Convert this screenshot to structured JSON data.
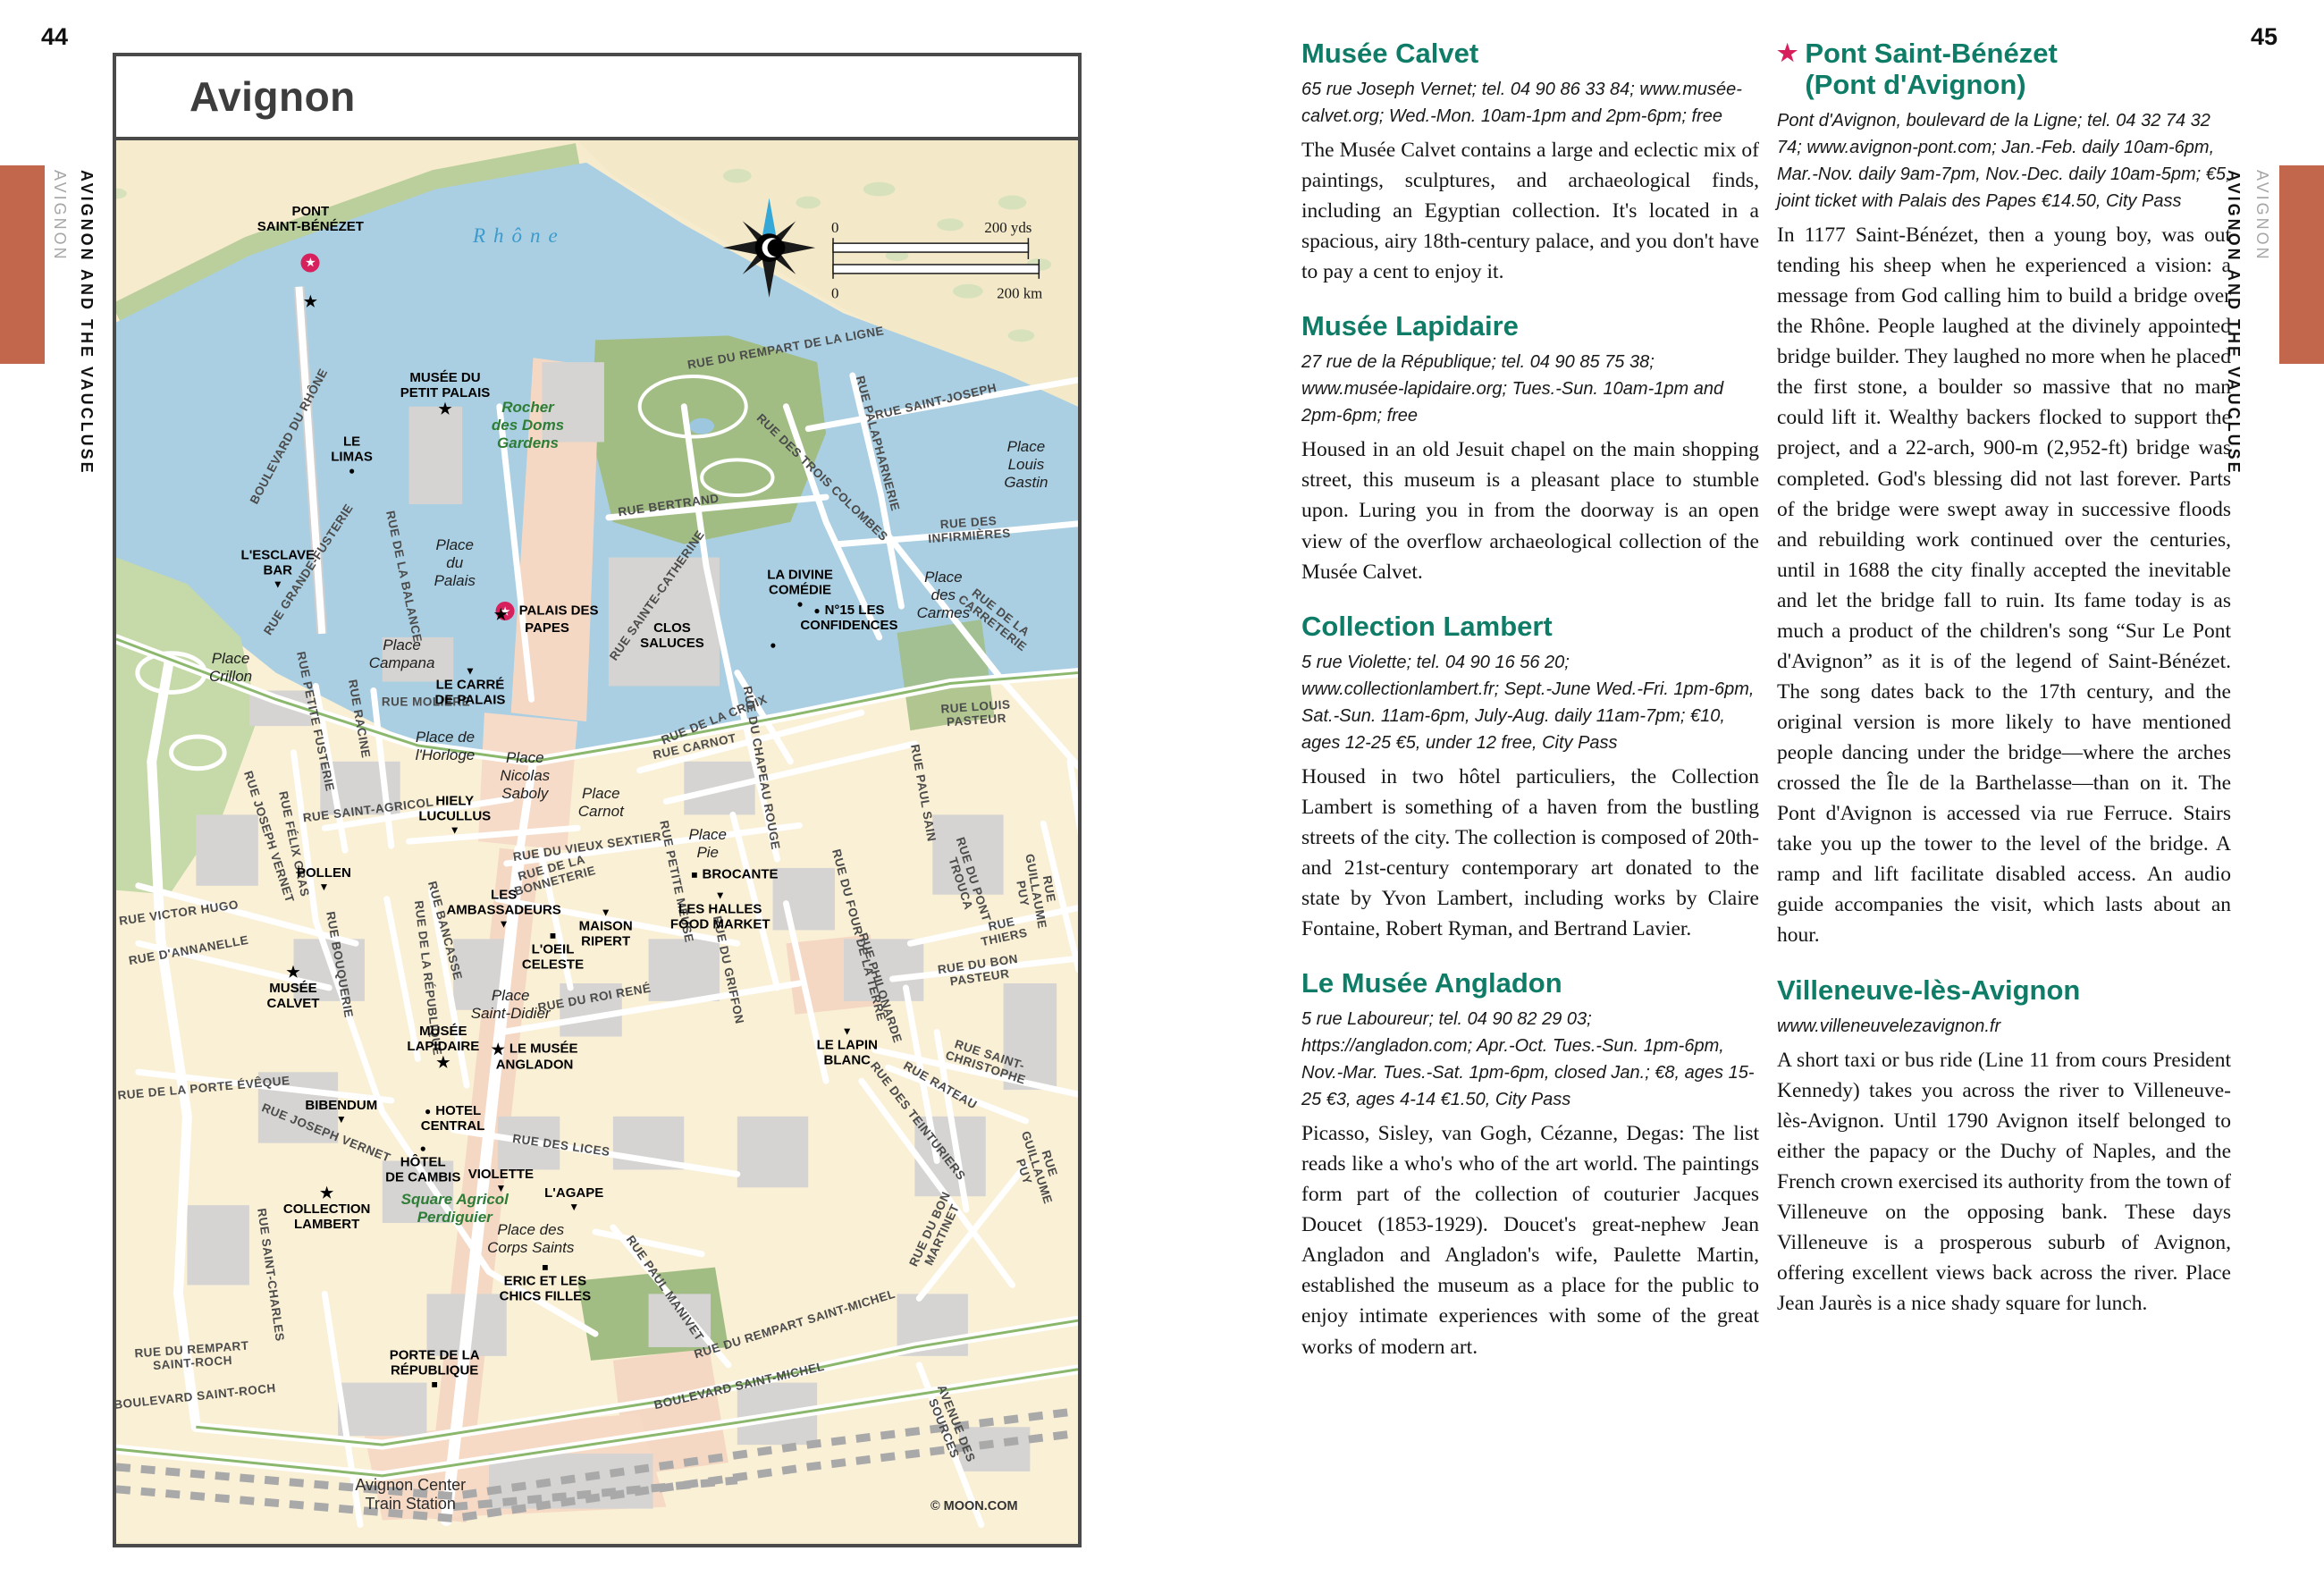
{
  "page": {
    "left_number": "44",
    "right_number": "45",
    "sidebar": {
      "title": "AVIGNON AND THE VAUCLUSE",
      "subtitle": "AVIGNON"
    },
    "accent_color": "#C2674B",
    "heading_color": "#0E7C66",
    "star_color": "#D71F5B"
  },
  "map": {
    "title": "Avignon",
    "credit": "© MOON.COM",
    "scale": {
      "zero_top": "0",
      "top": "200 yds",
      "zero_bottom": "0",
      "bottom": "200 km"
    },
    "labels": [
      {
        "t": "PONT\nSAINT-BÉNÉZET",
        "x": 20.2,
        "y": 5.6,
        "type": "poi"
      },
      {
        "t": "",
        "x": 20.2,
        "y": 8.7,
        "type": "glyph",
        "icon": "red-star"
      },
      {
        "t": "",
        "x": 20.2,
        "y": 11.5,
        "type": "glyph",
        "icon": "star"
      },
      {
        "t": "Rhône",
        "x": 41.9,
        "y": 6.8,
        "type": "water"
      },
      {
        "t": "BOULEVARD DU RHÔNE",
        "x": 17.9,
        "y": 21.1,
        "type": "street",
        "rot": -62
      },
      {
        "t": "RUE DU REMPART DE LA LIGNE",
        "x": 69.6,
        "y": 14.8,
        "type": "street",
        "rot": -10
      },
      {
        "t": "RUE SAINT-JOSEPH",
        "x": 85.2,
        "y": 18.6,
        "type": "street",
        "rot": -13
      },
      {
        "t": "RUE DES TROIS COLOMBES",
        "x": 73.4,
        "y": 24.0,
        "type": "street",
        "rot": 44
      },
      {
        "t": "RUE PALAPHARNERIE",
        "x": 79.2,
        "y": 21.6,
        "type": "street",
        "rot": 75
      },
      {
        "t": "RUE BERTRAND",
        "x": 57.4,
        "y": 26.0,
        "type": "street",
        "rot": -8
      },
      {
        "t": "RUE DES INFIRMIÈRES",
        "x": 88.7,
        "y": 27.7,
        "type": "street",
        "rot": -4
      },
      {
        "t": "RUE DE LA CARRETERIE",
        "x": 91.5,
        "y": 34.0,
        "type": "street",
        "rot": 38
      },
      {
        "t": "RUE SAINTE-CATHERINE",
        "x": 56.2,
        "y": 32.4,
        "type": "street",
        "rot": -55
      },
      {
        "t": "RUE GRANDE-FUSTERIE",
        "x": 20.0,
        "y": 30.6,
        "type": "street",
        "rot": -57
      },
      {
        "t": "RUE DE LA BALANCE",
        "x": 29.9,
        "y": 31.1,
        "type": "street",
        "rot": 78
      },
      {
        "t": "RUE LOUIS PASTEUR",
        "x": 89.4,
        "y": 40.8,
        "type": "street",
        "rot": -4
      },
      {
        "t": "RUE PETITE FUSTERIE",
        "x": 20.7,
        "y": 41.4,
        "type": "street",
        "rot": 78
      },
      {
        "t": "RUE RACINE",
        "x": 25.3,
        "y": 41.2,
        "type": "street",
        "rot": 80
      },
      {
        "t": "RUE MOLIÈRE",
        "x": 32.2,
        "y": 40.0,
        "type": "street"
      },
      {
        "t": "RUE SAINT-AGRICOL",
        "x": 26.2,
        "y": 47.7,
        "type": "street",
        "rot": -7
      },
      {
        "t": "RUE DE LA CROIX",
        "x": 62.2,
        "y": 41.3,
        "type": "street",
        "rot": -22
      },
      {
        "t": "RUE CARNOT",
        "x": 60.1,
        "y": 43.2,
        "type": "street",
        "rot": -12
      },
      {
        "t": "RUE DU CHAPEAU ROUGE",
        "x": 67.1,
        "y": 44.7,
        "type": "street",
        "rot": 80
      },
      {
        "t": "RUE PAUL SAIN",
        "x": 83.9,
        "y": 46.5,
        "type": "street",
        "rot": 80
      },
      {
        "t": "RUE DU VIEUX SEXTIER",
        "x": 49.0,
        "y": 50.3,
        "type": "street",
        "rot": -8
      },
      {
        "t": "RUE DE LA\nBONNETERIE",
        "x": 45.4,
        "y": 52.3,
        "type": "street",
        "rot": -15
      },
      {
        "t": "RUE PETITE MEUSE",
        "x": 58.3,
        "y": 52.8,
        "type": "street",
        "rot": 78
      },
      {
        "t": "RUE JOSEPH VERNET",
        "x": 15.9,
        "y": 49.6,
        "type": "street",
        "rot": 72
      },
      {
        "t": "RUE FÉLIX GRAS",
        "x": 18.5,
        "y": 50.1,
        "type": "street",
        "rot": 78
      },
      {
        "t": "RUE VICTOR HUGO",
        "x": 6.5,
        "y": 55.0,
        "type": "street",
        "rot": -8
      },
      {
        "t": "RUE D'ANNANELLE",
        "x": 7.5,
        "y": 57.7,
        "type": "street",
        "rot": -10
      },
      {
        "t": "RUE BOUQUERIE",
        "x": 23.2,
        "y": 58.7,
        "type": "street",
        "rot": 80
      },
      {
        "t": "RUE DE LA RÉPUBLIQUE",
        "x": 32.4,
        "y": 59.7,
        "type": "street",
        "rot": 83
      },
      {
        "t": "RUE BANCASSE",
        "x": 34.2,
        "y": 56.3,
        "type": "street",
        "rot": 75
      },
      {
        "t": "RUE DU GRIFFON",
        "x": 63.7,
        "y": 59.1,
        "type": "street",
        "rot": 78
      },
      {
        "t": "RUE DU ROI RENÉ",
        "x": 49.7,
        "y": 61.1,
        "type": "street",
        "rot": -10
      },
      {
        "t": "RUE DU FOUR DE LA TERRE",
        "x": 77.2,
        "y": 56.6,
        "type": "street",
        "rot": 75
      },
      {
        "t": "RUE PHILONARDE",
        "x": 79.5,
        "y": 60.4,
        "type": "street",
        "rot": 72
      },
      {
        "t": "RUE DU PONT TROUCA",
        "x": 88.5,
        "y": 52.8,
        "type": "street",
        "rot": 72
      },
      {
        "t": "RUE THIERS",
        "x": 92.2,
        "y": 56.3,
        "type": "street",
        "rot": -12
      },
      {
        "t": "RUE GUILLAUME PUY",
        "x": 95.6,
        "y": 53.5,
        "type": "street",
        "rot": 80
      },
      {
        "t": "RUE DU BON PASTEUR",
        "x": 89.7,
        "y": 59.2,
        "type": "street",
        "rot": -8
      },
      {
        "t": "RUE SAINT-CHRISTOPHE",
        "x": 90.6,
        "y": 65.6,
        "type": "street",
        "rot": 18
      },
      {
        "t": "RUE RATEAU",
        "x": 85.7,
        "y": 67.3,
        "type": "street",
        "rot": 30
      },
      {
        "t": "RUE DES TEINTURIERS",
        "x": 83.4,
        "y": 69.9,
        "type": "street",
        "rot": 52
      },
      {
        "t": "RUE GUILLAUME PUY",
        "x": 95.7,
        "y": 73.2,
        "type": "street",
        "rot": 72
      },
      {
        "t": "RUE DU BON MARTINET",
        "x": 85.2,
        "y": 77.8,
        "type": "street",
        "rot": -65
      },
      {
        "t": "RUE DE LA PORTE ÉVÊQUE",
        "x": 9.1,
        "y": 67.5,
        "type": "street",
        "rot": -5
      },
      {
        "t": "RUE JOSEPH VERNET",
        "x": 21.8,
        "y": 70.7,
        "type": "street",
        "rot": 22
      },
      {
        "t": "RUE SAINT-CHARLES",
        "x": 16.1,
        "y": 80.8,
        "type": "street",
        "rot": 82
      },
      {
        "t": "RUE DES LICES",
        "x": 46.3,
        "y": 71.6,
        "type": "street",
        "rot": 8
      },
      {
        "t": "RUE DU REMPART\nSAINT-ROCH",
        "x": 7.9,
        "y": 86.6,
        "type": "street",
        "rot": -4
      },
      {
        "t": "BOULEVARD SAINT-ROCH",
        "x": 8.2,
        "y": 89.5,
        "type": "street",
        "rot": -6
      },
      {
        "t": "RUE PAUL MANIVET",
        "x": 57.1,
        "y": 81.8,
        "type": "street",
        "rot": 55
      },
      {
        "t": "RUE DU REMPART SAINT-MICHEL",
        "x": 70.5,
        "y": 84.3,
        "type": "street",
        "rot": -17
      },
      {
        "t": "BOULEVARD SAINT-MICHEL",
        "x": 64.8,
        "y": 88.7,
        "type": "street",
        "rot": -13
      },
      {
        "t": "AVENUE DES SOURCES",
        "x": 86.7,
        "y": 91.6,
        "type": "street",
        "rot": 68
      },
      {
        "t": "Place\nLouis\nGastin",
        "x": 94.6,
        "y": 23.1,
        "type": "place"
      },
      {
        "t": "Place\ndes\nCarmes",
        "x": 86.0,
        "y": 32.4,
        "type": "place"
      },
      {
        "t": "Place\ndu\nPalais",
        "x": 35.2,
        "y": 30.1,
        "type": "place"
      },
      {
        "t": "Place\nCampana",
        "x": 29.7,
        "y": 36.6,
        "type": "place"
      },
      {
        "t": "Place\nCrillon",
        "x": 11.9,
        "y": 37.6,
        "type": "place"
      },
      {
        "t": "Place de\nl'Horloge",
        "x": 34.2,
        "y": 43.2,
        "type": "place"
      },
      {
        "t": "Place\nNicolas\nSaboly",
        "x": 42.5,
        "y": 45.3,
        "type": "place"
      },
      {
        "t": "Place\nCarnot",
        "x": 50.4,
        "y": 47.2,
        "type": "place"
      },
      {
        "t": "Place\nPie",
        "x": 61.5,
        "y": 50.1,
        "type": "place"
      },
      {
        "t": "Place\nSaint-Didier",
        "x": 41.0,
        "y": 61.6,
        "type": "place"
      },
      {
        "t": "Place des\nCorps Saints",
        "x": 43.1,
        "y": 78.3,
        "type": "place"
      },
      {
        "t": "Rocher\ndes Doms\nGardens",
        "x": 42.8,
        "y": 20.3,
        "type": "park"
      },
      {
        "t": "Square Agricol\nPerdiguier",
        "x": 35.2,
        "y": 76.1,
        "type": "park"
      },
      {
        "t": "LE\nLIMAS",
        "x": 24.5,
        "y": 22.4,
        "type": "poi",
        "icon": "dot",
        "ipos": "b"
      },
      {
        "t": "MUSÉE DU\nPETIT PALAIS",
        "x": 34.2,
        "y": 18.0,
        "type": "poi",
        "icon": "star",
        "ipos": "b"
      },
      {
        "t": "L'ESCLAVE\nBAR",
        "x": 16.8,
        "y": 30.5,
        "type": "poi",
        "icon": "tri",
        "ipos": "b"
      },
      {
        "t": "PALAIS DES\nPAPES",
        "x": 44.8,
        "y": 34.1,
        "type": "poi",
        "icon": "red-star",
        "ipos": "l"
      },
      {
        "t": "",
        "x": 40.0,
        "y": 33.8,
        "type": "glyph",
        "icon": "star"
      },
      {
        "t": "LA DIVINE\nCOMÉDIE",
        "x": 71.1,
        "y": 31.9,
        "type": "poi",
        "icon": "dot",
        "ipos": "b"
      },
      {
        "t": "N°15 LES\nCONFIDENCES",
        "x": 76.2,
        "y": 34.0,
        "type": "poi",
        "icon": "dot",
        "ipos": "l"
      },
      {
        "t": "CLOS\nSALUCES",
        "x": 57.8,
        "y": 35.3,
        "type": "poi"
      },
      {
        "t": "",
        "x": 68.3,
        "y": 35.9,
        "type": "glyph",
        "icon": "dot"
      },
      {
        "t": "LE CARRÉ\nDE PALAIS",
        "x": 36.8,
        "y": 38.9,
        "type": "poi",
        "icon": "tri",
        "ipos": "a"
      },
      {
        "t": "HIELY\nLUCULLUS",
        "x": 35.2,
        "y": 48.0,
        "type": "poi",
        "icon": "tri",
        "ipos": "b"
      },
      {
        "t": "BROCANTE",
        "x": 64.3,
        "y": 52.3,
        "type": "poi",
        "icon": "sq",
        "ipos": "l"
      },
      {
        "t": "LES HALLES\nFOOD MARKET",
        "x": 62.8,
        "y": 54.9,
        "type": "poi",
        "icon": "tri",
        "ipos": "a"
      },
      {
        "t": "POLLEN",
        "x": 21.6,
        "y": 52.6,
        "type": "poi",
        "icon": "tri",
        "ipos": "b"
      },
      {
        "t": "LES\nAMBASSADEURS",
        "x": 40.3,
        "y": 54.7,
        "type": "poi",
        "icon": "tri",
        "ipos": "b"
      },
      {
        "t": "MAISON\nRIPERT",
        "x": 50.9,
        "y": 56.1,
        "type": "poi",
        "icon": "tri",
        "ipos": "a"
      },
      {
        "t": "L'OEIL\nCELESTE",
        "x": 45.4,
        "y": 57.8,
        "type": "poi",
        "icon": "sq",
        "ipos": "a"
      },
      {
        "t": "MUSÉE\nCALVET",
        "x": 18.4,
        "y": 60.4,
        "type": "poi",
        "icon": "star",
        "ipos": "a"
      },
      {
        "t": "LE LAPIN\nBLANC",
        "x": 76.0,
        "y": 64.6,
        "type": "poi",
        "icon": "tri",
        "ipos": "a"
      },
      {
        "t": "BIBENDUM",
        "x": 23.4,
        "y": 69.2,
        "type": "poi",
        "icon": "tri",
        "ipos": "b"
      },
      {
        "t": "MUSÉE\nLAPIDAIRE",
        "x": 34.0,
        "y": 64.6,
        "type": "poi",
        "icon": "star",
        "ipos": "b"
      },
      {
        "t": "LE MUSÉE\nANGLADON",
        "x": 43.5,
        "y": 65.3,
        "type": "poi",
        "icon": "star",
        "ipos": "l"
      },
      {
        "t": "HOTEL\nCENTRAL",
        "x": 35.0,
        "y": 69.7,
        "type": "poi",
        "icon": "dot",
        "ipos": "l"
      },
      {
        "t": "HÔTEL\nDE CAMBIS",
        "x": 31.9,
        "y": 72.9,
        "type": "poi",
        "icon": "dot",
        "ipos": "a"
      },
      {
        "t": "COLLECTION\nLAMBERT",
        "x": 21.9,
        "y": 76.1,
        "type": "poi",
        "icon": "star",
        "ipos": "a"
      },
      {
        "t": "VIOLETTE",
        "x": 40.0,
        "y": 74.1,
        "type": "poi",
        "icon": "tri",
        "ipos": "b"
      },
      {
        "t": "L'AGAPE",
        "x": 47.6,
        "y": 75.4,
        "type": "poi",
        "icon": "tri",
        "ipos": "b"
      },
      {
        "t": "ERIC ET LES\nCHICS FILLES",
        "x": 44.6,
        "y": 81.4,
        "type": "poi",
        "icon": "sq",
        "ipos": "a"
      },
      {
        "t": "PORTE DE LA\nRÉPUBLIQUE",
        "x": 33.1,
        "y": 87.5,
        "type": "poi",
        "icon": "sq",
        "ipos": "b"
      },
      {
        "t": "Avignon Center\nTrain Station",
        "x": 30.6,
        "y": 96.5,
        "type": "station"
      },
      {
        "t": "© MOON.COM",
        "x": 89.2,
        "y": 97.3,
        "type": "credit"
      }
    ]
  },
  "articles": {
    "col1": [
      {
        "star": false,
        "title": "Musée Calvet",
        "info": "65 rue Joseph Vernet; tel. 04 90 86 33 84; www.musée-calvet.org; Wed.-Mon. 10am-1pm and 2pm-6pm; free",
        "body": "The Musée Calvet contains a large and eclectic mix of paintings, sculptures, and archaeological finds, including an Egyptian collection. It's located in a spacious, airy 18th-century palace, and you don't have to pay a cent to enjoy it."
      },
      {
        "star": false,
        "title": "Musée Lapidaire",
        "info": "27 rue de la République; tel. 04 90 85 75 38; www.musée-lapidaire.org; Tues.-Sun. 10am-1pm and 2pm-6pm; free",
        "body": "Housed in an old Jesuit chapel on the main shopping street, this museum is a pleasant place to stumble upon. Luring you in from the doorway is an open view of the overflow archaeological collection of the Musée Calvet."
      },
      {
        "star": false,
        "title": "Collection Lambert",
        "info": "5 rue Violette; tel. 04 90 16 56 20; www.collectionlambert.fr; Sept.-June Wed.-Fri. 1pm-6pm, Sat.-Sun. 11am-6pm, July-Aug. daily 11am-7pm; €10, ages 12-25 €5, under 12 free, City Pass",
        "body": "Housed in two hôtel particuliers, the Collection Lambert is something of a haven from the bustling streets of the city. The collection is composed of 20th- and 21st-century contemporary art donated to the state by Yvon Lambert, including works by Claire Fontaine, Robert Ryman, and Bertrand Lavier."
      },
      {
        "star": false,
        "title": "Le Musée Angladon",
        "info": "5 rue Laboureur; tel. 04 90 82 29 03; https://angladon.com; Apr.-Oct. Tues.-Sun. 1pm-6pm, Nov.-Mar. Tues.-Sat. 1pm-6pm, closed Jan.; €8, ages 15-25 €3, ages 4-14 €1.50, City Pass",
        "body": "Picasso, Sisley, van Gogh, Cézanne, Degas: The list reads like a who's who of the art world. The paintings form part of the collection of couturier Jacques Doucet (1853-1929). Doucet's great-nephew Jean Angladon and Angladon's wife, Paulette Martin, established the museum as a place for the public to enjoy intimate experiences with some of the great works of modern art."
      }
    ],
    "col2": [
      {
        "star": true,
        "title": "Pont Saint-Bénézet\n(Pont d'Avignon)",
        "info": "Pont d'Avignon, boulevard de la Ligne; tel. 04 32 74 32 74; www.avignon-pont.com; Jan.-Feb. daily 10am-6pm, Mar.-Nov. daily 9am-7pm, Nov.-Dec. daily 10am-5pm; €5, joint ticket with Palais des Papes €14.50, City Pass",
        "body": "In 1177 Saint-Bénézet, then a young boy, was out tending his sheep when he experienced a vision: a message from God calling him to build a bridge over the Rhône. People laughed at the divinely appointed bridge builder. They laughed no more when he placed the first stone, a boulder so massive that no man could lift it. Wealthy backers flocked to support the project, and a 22-arch, 900-m (2,952-ft) bridge was completed. God's blessing did not last forever. Parts of the bridge were swept away in successive floods and rebuilding work continued over the centuries, until in 1688 the city finally accepted the inevitable and let the bridge fall to ruin. Its fame today is as much a product of the children's song “Sur Le Pont d'Avignon” as it is of the legend of Saint-Bénézet. The song dates back to the 17th century, and the original version is more likely to have mentioned people dancing under the bridge—where the arches crossed the Île de la Barthelasse—than on it. The Pont d'Avignon is accessed via rue Ferruce. Stairs take you up the tower to the level of the bridge. A ramp and lift facilitate disabled access. An audio guide accompanies the visit, which lasts about an hour."
      },
      {
        "star": false,
        "title": "Villeneuve-lès-Avignon",
        "info": "www.villeneuvelezavignon.fr",
        "body": "A short taxi or bus ride (Line 11 from cours President Kennedy) takes you across the river to Villeneuve-lès-Avignon. Until 1790 Avignon itself belonged to either the papacy or the Duchy of Naples, and the French crown exercised its authority from the town of Villeneuve on the opposing bank. These days Villeneuve is a prosperous suburb of Avignon, offering excellent views back across the river. Place Jean Jaurès is a nice shady square for lunch."
      }
    ]
  }
}
